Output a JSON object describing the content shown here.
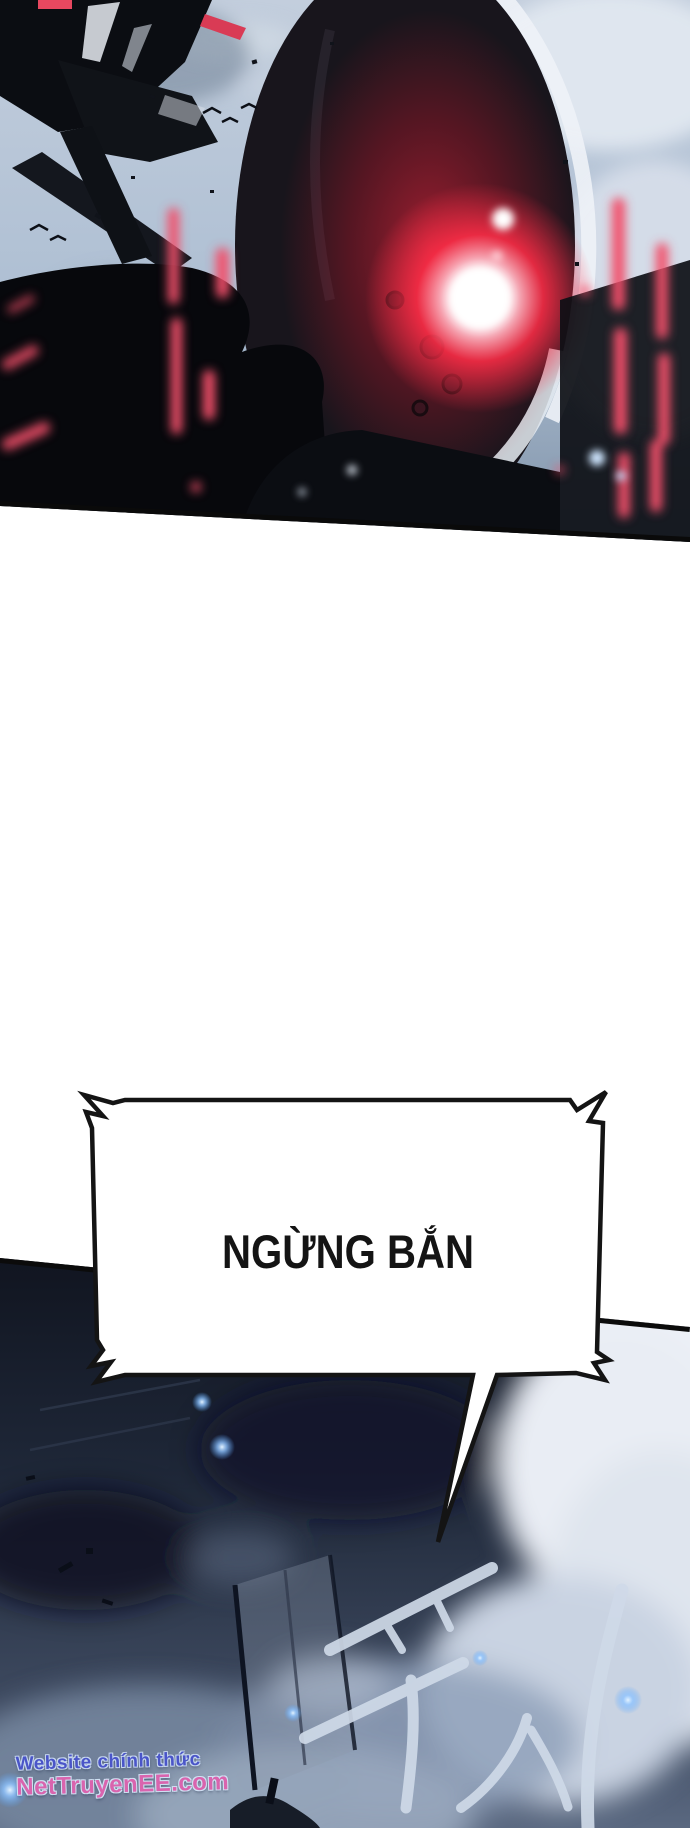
{
  "page": {
    "background": "#ffffff",
    "width": 690,
    "height": 1828
  },
  "panels": {
    "top": {
      "description": "robot-with-glowing-red-eye",
      "sky_color": "#aebfd3",
      "armor_color": "#0b0d12",
      "accent_red": "#f2506a",
      "eye_glow_color": "#ff2d47"
    },
    "bottom": {
      "description": "dark-battlefield-with-smoke",
      "bg_color": "#1f2839",
      "cloud_color": "#e9edf4",
      "glow_color": "#bfe0ff",
      "sfx_text": "푸시"
    }
  },
  "speech_bubble": {
    "text": "NGỪNG BẮN",
    "fill": "#ffffff",
    "border_color": "#141414"
  },
  "watermark": {
    "line1": "Website chính thức",
    "line2": "NetTruyenEE.com",
    "line1_color": "#4a55c8",
    "line2_color": "#d964ae"
  }
}
